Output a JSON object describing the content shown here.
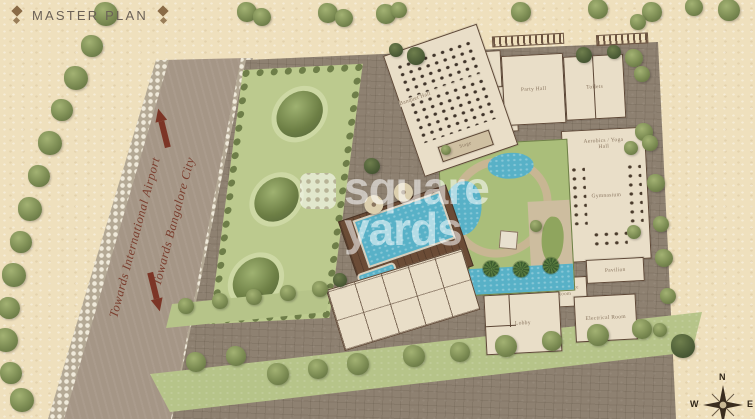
{
  "header": {
    "title": "MASTER PLAN"
  },
  "road": {
    "label_airport": "Towards International Airport",
    "label_city": "Towards Bangalore City"
  },
  "buildings": {
    "banquet_hall": "Banquet Hall",
    "stage": "Stage",
    "kitchen": "Kitchen",
    "lobby_upper": "Lobby",
    "party_hall": "Party Hall",
    "toilets": "Toilets",
    "aerobics_yoga": "Aerobics / Yoga Hall",
    "gymnasium": "Gymnasium",
    "pavilion": "Pavilion",
    "maintenance": "Maintenance Room",
    "electrical": "Electrical Room",
    "lobby_lower": "Lobby"
  },
  "compass": {
    "n": "N",
    "e": "E",
    "w": "W",
    "s": "S"
  },
  "watermark": {
    "line1": "square",
    "line2": "yards"
  },
  "palette": {
    "page_beige": "#efe0bd",
    "road": "#a59686",
    "paving": "#8e8171",
    "lawn": "#b6c489",
    "water": "#58b1c7",
    "deck": "#6b4c36",
    "wall": "#5d4736",
    "arrow_red": "#7c3526",
    "title_text": "#6b6157",
    "road_text": "#7b3e2e"
  }
}
